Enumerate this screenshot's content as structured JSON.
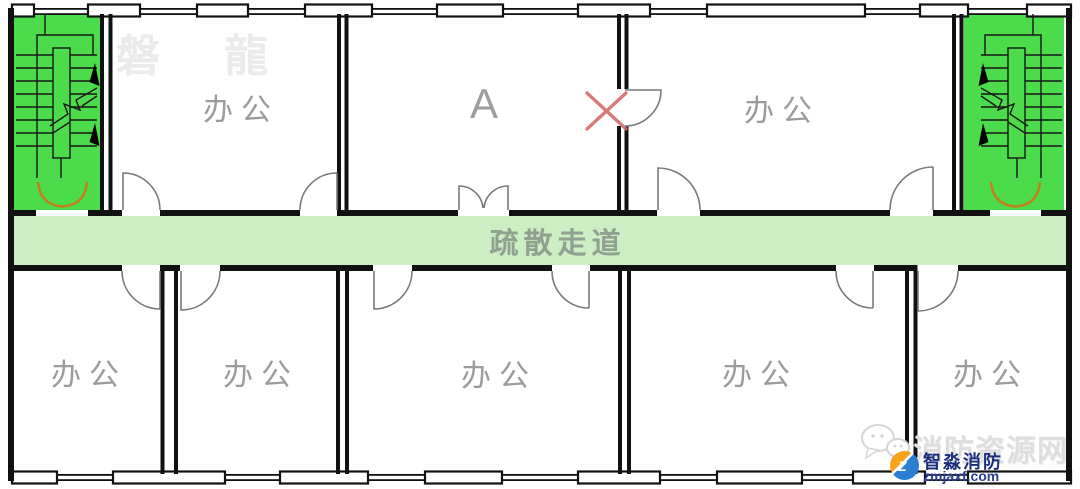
{
  "rooms": {
    "top_left": "办公",
    "room_a": "A",
    "top_right": "办公",
    "bottom_1": "办公",
    "bottom_2": "办公",
    "bottom_3": "办公",
    "bottom_4": "办公",
    "bottom_5": "办公"
  },
  "corridor": {
    "label": "疏散走道"
  },
  "watermarks": {
    "panlong": "磐 龍",
    "fire_resource": "消防资源网"
  },
  "logo": {
    "name": "智淼消防",
    "site": "zmjaxf.com",
    "initial": "Z"
  },
  "colors": {
    "stair_green": "#4bdb4b",
    "corridor_green": "#cbeec3",
    "wall_black": "#111111",
    "door_gray": "#7a7a7a",
    "stair_door_orange": "#c0801e",
    "blocked_x_red": "#d56b6b",
    "label_gray": "#9c9c9c"
  }
}
